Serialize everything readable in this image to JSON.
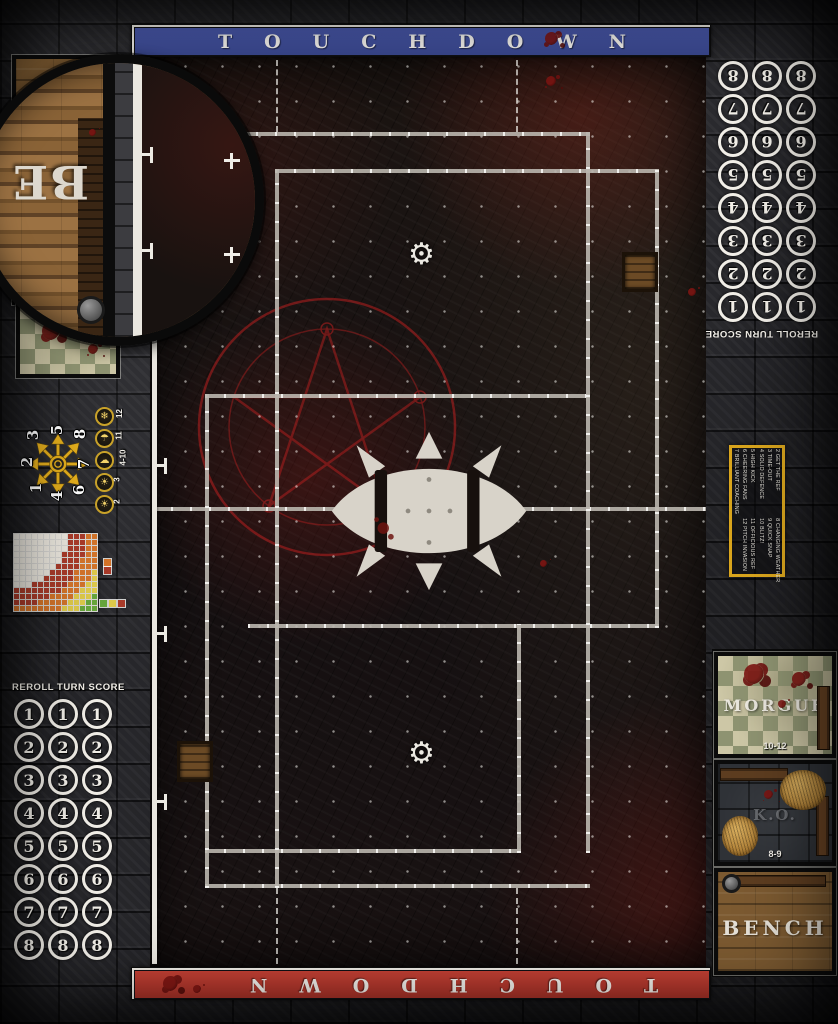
{
  "banners": {
    "top": {
      "label": "TOUCHDOWN",
      "color": "#3e4da1"
    },
    "bottom": {
      "label": "TOUCHDOWN",
      "color": "#c13a30"
    }
  },
  "score_track": {
    "header": "REROLL TURN SCORE",
    "values": [
      "1",
      "2",
      "3",
      "4",
      "5",
      "6",
      "7",
      "8"
    ],
    "columns": 3
  },
  "kickoff_table": {
    "entries_col1": [
      "2 GET THE REF",
      "3 TIME-OUT",
      "4 SOLID DEFENCE",
      "5 HIGH KICK",
      "6 CHEERING FANS",
      "7 BRILLIANT COACHING"
    ],
    "entries_col2": [
      "8 CHANGING WEATHER",
      "9 QUICK SNAP",
      "10 BLITZ!",
      "11 OFFICIOUS REF",
      "12 PITCH INVASION"
    ]
  },
  "weather_track": {
    "entries": [
      {
        "value": "12",
        "icon": "blizzard-icon",
        "glyph": "❄"
      },
      {
        "value": "11",
        "icon": "rain-icon",
        "glyph": "☂"
      },
      {
        "value": "4-10",
        "icon": "partly-cloudy-icon",
        "glyph": "☁"
      },
      {
        "value": "3",
        "icon": "sunny-icon",
        "glyph": "☀"
      },
      {
        "value": "2",
        "icon": "sweltering-heat-icon",
        "glyph": "☀"
      }
    ]
  },
  "scatter_template": {
    "numbers": [
      {
        "label": "1",
        "pos": "sw"
      },
      {
        "label": "2",
        "pos": "w"
      },
      {
        "label": "3",
        "pos": "nw"
      },
      {
        "label": "4",
        "pos": "s"
      },
      {
        "label": "5",
        "pos": "n"
      },
      {
        "label": "6",
        "pos": "se"
      },
      {
        "label": "7",
        "pos": "e"
      },
      {
        "label": "8",
        "pos": "ne"
      }
    ]
  },
  "range_chart": {
    "cols": 14,
    "rows": 13,
    "bands": [
      {
        "max": 9,
        "color": "#ece8df"
      },
      {
        "max": 12.2,
        "color": "#a93b2a"
      },
      {
        "max": 14.6,
        "color": "#d3742a"
      },
      {
        "max": 16.6,
        "color": "#ddc94a"
      },
      {
        "max": 99,
        "color": "#67a53c"
      }
    ],
    "legend_right": [
      "#d3742a",
      "#a93b2a"
    ],
    "legend_bottom": [
      "#67a53c",
      "#ddc94a",
      "#a93b2a"
    ]
  },
  "dugout": {
    "morgue": {
      "label": "MORGUE",
      "range": "10-12"
    },
    "ko": {
      "label": "K.O.",
      "range": "8-9"
    },
    "bench": {
      "label": "BENCH"
    }
  },
  "magnifier": {
    "label": "BE"
  },
  "field": {
    "gear_glyph": "⚙"
  }
}
